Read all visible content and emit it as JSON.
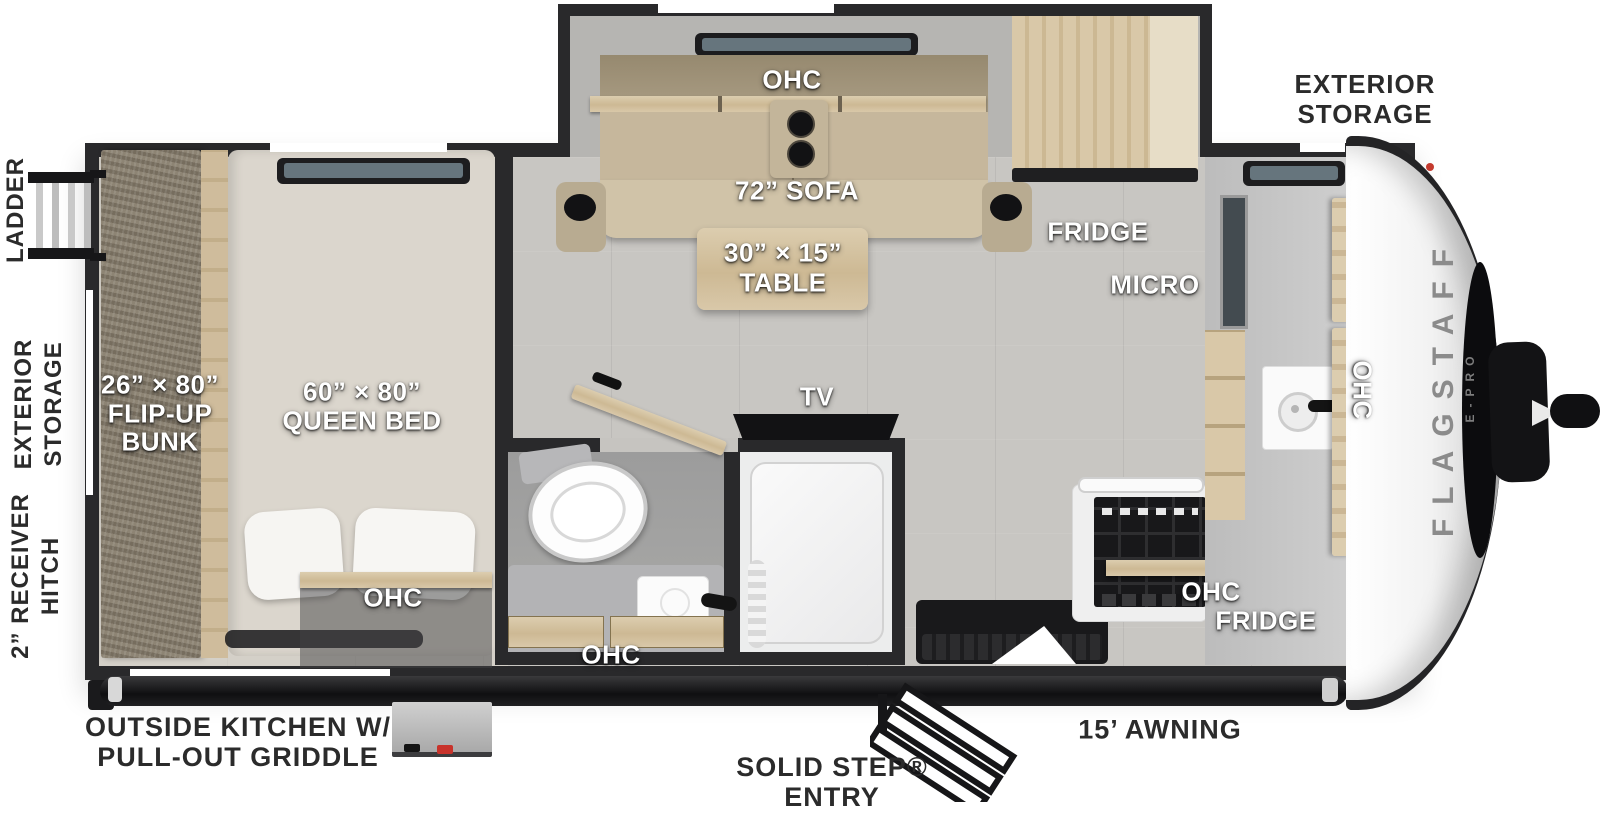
{
  "branding": {
    "model": "FLAGSTAFF",
    "series": "E-PRO"
  },
  "exterior_labels": {
    "ladder": "LADDER",
    "rear_storage_line1": "EXTERIOR",
    "rear_storage_line2": "STORAGE",
    "hitch_line1": "2” RECEIVER",
    "hitch_line2": "HITCH",
    "front_storage_line1": "EXTERIOR",
    "front_storage_line2": "STORAGE",
    "outside_kitchen_line1": "OUTSIDE KITCHEN W/",
    "outside_kitchen_line2": "PULL-OUT GRIDDLE",
    "entry_line1": "SOLID STEP®",
    "entry_line2": "ENTRY",
    "awning": "15’ AWNING"
  },
  "room_labels": {
    "bunk_size": "26” × 80”",
    "bunk_line2": "FLIP-UP",
    "bunk_line3": "BUNK",
    "queen_size": "60” × 80”",
    "queen_name": "QUEEN BED",
    "sofa": "72” SOFA",
    "table_size": "30” × 15”",
    "table_name": "TABLE",
    "ohc": "OHC",
    "fridge": "FRIDGE",
    "micro": "MICRO",
    "tv": "TV"
  },
  "colors": {
    "wall": "#29292b",
    "floor": "#c8c6c2",
    "wood": "#d2c0a0",
    "sofa_fabric": "#c6b79c",
    "cap_white": "#f4f4f4",
    "accent_red": "#c8332b",
    "label_dark": "#2b2b2b"
  }
}
